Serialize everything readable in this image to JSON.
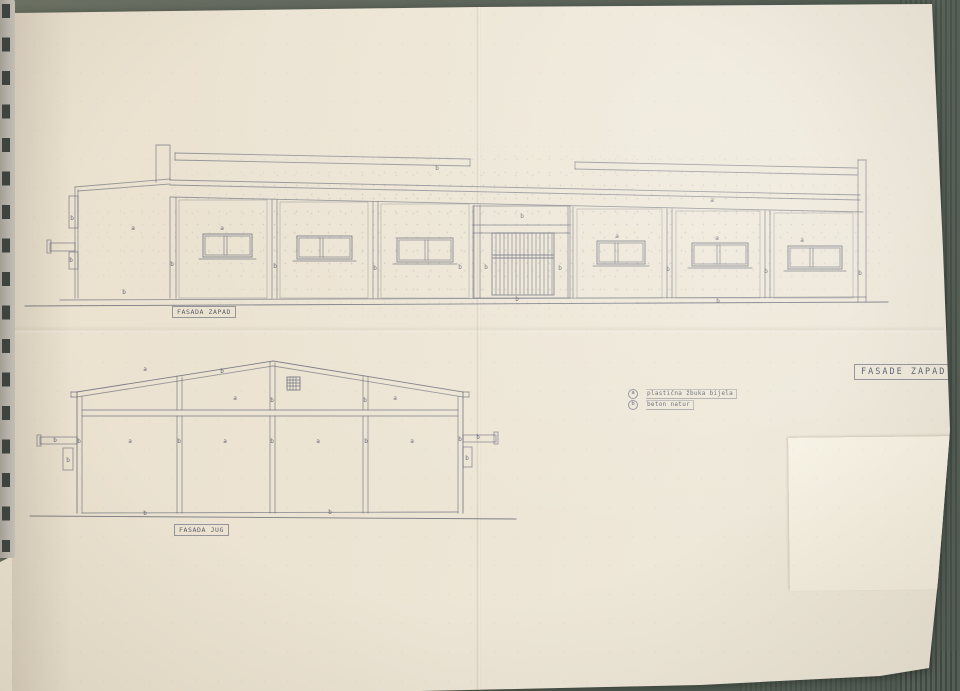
{
  "scene": {
    "table_color": "#5d655b",
    "paper_color": "#ece4d3",
    "ink_color": "#5f6372",
    "patch_color": "#f6f0e2"
  },
  "sheet_title": "FASADE ZAPAD I",
  "legend": {
    "items": [
      {
        "key": "a",
        "text": "plastična žbuka bijela"
      },
      {
        "key": "b",
        "text": "beton natur"
      }
    ]
  },
  "west_elevation": {
    "caption": "FASADA ZAPAD",
    "labels": [
      {
        "t": "a",
        "x": 113,
        "y": 90
      },
      {
        "t": "b",
        "x": 52,
        "y": 80
      },
      {
        "t": "b",
        "x": 51,
        "y": 122
      },
      {
        "t": "b",
        "x": 104,
        "y": 154
      },
      {
        "t": "a",
        "x": 202,
        "y": 90
      },
      {
        "t": "b",
        "x": 152,
        "y": 126
      },
      {
        "t": "b",
        "x": 255,
        "y": 128
      },
      {
        "t": "b",
        "x": 355,
        "y": 130
      },
      {
        "t": "b",
        "x": 440,
        "y": 129
      },
      {
        "t": "b",
        "x": 502,
        "y": 78
      },
      {
        "t": "b",
        "x": 466,
        "y": 129
      },
      {
        "t": "b",
        "x": 540,
        "y": 130
      },
      {
        "t": "b",
        "x": 417,
        "y": 30
      },
      {
        "t": "a",
        "x": 692,
        "y": 62
      },
      {
        "t": "a",
        "x": 597,
        "y": 98
      },
      {
        "t": "a",
        "x": 697,
        "y": 100
      },
      {
        "t": "a",
        "x": 782,
        "y": 102
      },
      {
        "t": "b",
        "x": 648,
        "y": 131
      },
      {
        "t": "b",
        "x": 746,
        "y": 133
      },
      {
        "t": "b",
        "x": 840,
        "y": 135
      },
      {
        "t": "b",
        "x": 497,
        "y": 161
      },
      {
        "t": "b",
        "x": 698,
        "y": 163
      }
    ]
  },
  "south_elevation": {
    "caption": "FASADA JUG",
    "labels": [
      {
        "t": "a",
        "x": 125,
        "y": 21
      },
      {
        "t": "b",
        "x": 202,
        "y": 23
      },
      {
        "t": "a",
        "x": 215,
        "y": 50
      },
      {
        "t": "b",
        "x": 252,
        "y": 52
      },
      {
        "t": "a",
        "x": 375,
        "y": 50
      },
      {
        "t": "b",
        "x": 345,
        "y": 52
      },
      {
        "t": "a",
        "x": 110,
        "y": 93
      },
      {
        "t": "a",
        "x": 205,
        "y": 93
      },
      {
        "t": "a",
        "x": 298,
        "y": 93
      },
      {
        "t": "a",
        "x": 392,
        "y": 93
      },
      {
        "t": "b",
        "x": 59,
        "y": 93
      },
      {
        "t": "b",
        "x": 159,
        "y": 93
      },
      {
        "t": "b",
        "x": 252,
        "y": 93
      },
      {
        "t": "b",
        "x": 346,
        "y": 93
      },
      {
        "t": "b",
        "x": 440,
        "y": 91
      },
      {
        "t": "b",
        "x": 35,
        "y": 92
      },
      {
        "t": "b",
        "x": 48,
        "y": 112
      },
      {
        "t": "b",
        "x": 458,
        "y": 89
      },
      {
        "t": "b",
        "x": 447,
        "y": 110
      },
      {
        "t": "b",
        "x": 125,
        "y": 165
      },
      {
        "t": "b",
        "x": 310,
        "y": 164
      }
    ]
  }
}
